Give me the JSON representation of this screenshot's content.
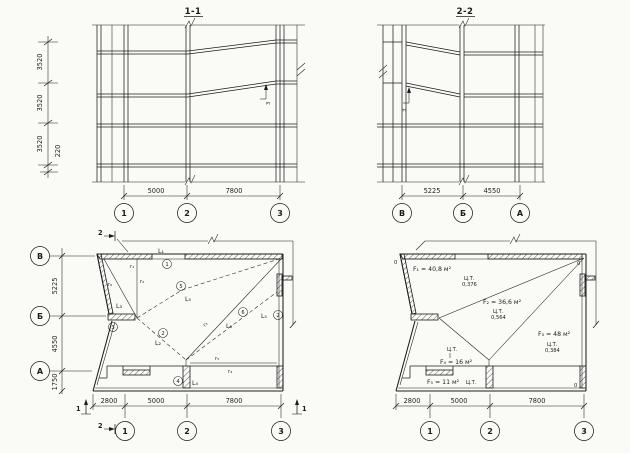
{
  "scan": {
    "bg": "#fafaf7",
    "ink": "#1c1c1c"
  },
  "section_11": {
    "title": "1-1",
    "vdims": [
      "3520",
      "3520",
      "3520"
    ],
    "vdim_small": "220",
    "hdims": [
      "5000",
      "7800"
    ],
    "bubbles": [
      "1",
      "2",
      "3"
    ],
    "callout": "3"
  },
  "section_22": {
    "title": "2-2",
    "hdims": [
      "5225",
      "4550"
    ],
    "bubbles": [
      "В",
      "Б",
      "А"
    ],
    "callout": "3"
  },
  "plan_left": {
    "row_bubbles": [
      "В",
      "Б",
      "А"
    ],
    "vdims": [
      "5225",
      "4550",
      "1750"
    ],
    "hdims": [
      "2800",
      "5000",
      "7800"
    ],
    "col_bubbles": [
      "1",
      "2",
      "3"
    ],
    "marks": {
      "sec2": "2",
      "sec1": "1"
    },
    "labels": {
      "L1": "L₁",
      "c1": "1",
      "r1": "r₁",
      "r2": "r₂",
      "r6": "r₆",
      "L3": "L₃",
      "c3": "3",
      "c5": "5",
      "L5": "L₅",
      "c2": "2",
      "L2": "L₂",
      "r3": "r₃",
      "c6": "6",
      "L6": "L₆",
      "L5b": "L₅",
      "c2b": "2",
      "c4": "4",
      "L4": "L₄",
      "r5": "r₅",
      "r4": "r₄"
    }
  },
  "plan_right": {
    "hdims": [
      "2800",
      "5000",
      "7800"
    ],
    "col_bubbles": [
      "1",
      "2",
      "3"
    ],
    "anchor": "0",
    "areas": {
      "f1": {
        "label": "F₁ = 40,8 м²",
        "ct": "Ц.Т.",
        "val": "0,376"
      },
      "f2": {
        "label": "F₂ = 36,6 м²",
        "ct": "Ц.Т.",
        "val": "0,564"
      },
      "f3": {
        "label": "F₃ = 48 м²",
        "ct": "Ц.Т.",
        "val": "0,384"
      },
      "f4": {
        "label": "F₄ = 16 м²",
        "ct": "Ц.Т."
      },
      "f5": {
        "label": "F₅ = 11 м²",
        "ct": "Ц.Т."
      }
    }
  }
}
